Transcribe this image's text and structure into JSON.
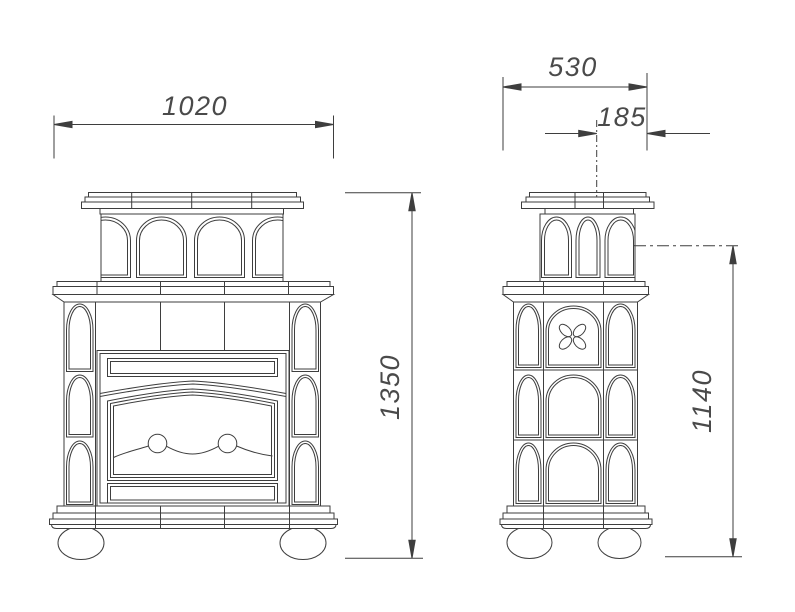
{
  "canvas": {
    "background": "#ffffff",
    "line_color": "#3e3e3e",
    "dim_text_color": "#4a4a4a"
  },
  "dimensions": {
    "front_width": "1020",
    "side_depth": "530",
    "flue_axis_offset": "185",
    "overall_height": "1350",
    "flue_axis_height": "1140"
  }
}
